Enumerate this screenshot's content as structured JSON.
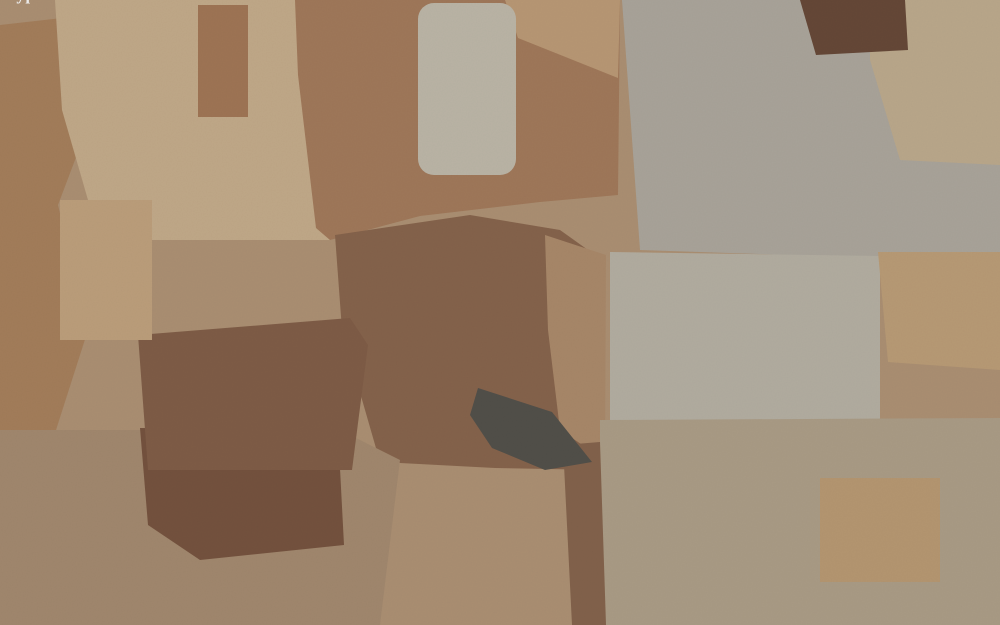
{
  "watermarks": {
    "top_left": {
      "text": "BuySell Cyprus",
      "x": 108,
      "y": 106,
      "angle": -45,
      "size": 27
    },
    "bottom_right": {
      "text": "BuySell Cyprus",
      "x": 887,
      "y": 523,
      "angle": -46,
      "size": 28
    }
  },
  "overlay": {
    "color": "#d61616",
    "stroke_width": 2.6,
    "parcels": [
      [
        [
          404,
          210
        ],
        [
          520,
          249
        ],
        [
          541,
          263
        ],
        [
          552,
          287
        ],
        [
          557,
          322
        ],
        [
          561,
          362
        ],
        [
          564,
          402
        ],
        [
          567,
          440
        ],
        [
          571,
          461
        ],
        [
          556,
          453
        ],
        [
          551,
          418
        ],
        [
          547,
          378
        ],
        [
          541,
          343
        ],
        [
          532,
          316
        ],
        [
          516,
          296
        ],
        [
          490,
          279
        ],
        [
          393,
          239
        ]
      ],
      [
        [
          466,
          213
        ],
        [
          531,
          241
        ],
        [
          578,
          263
        ],
        [
          603,
          278
        ],
        [
          604,
          332
        ],
        [
          600,
          392
        ],
        [
          597,
          442
        ],
        [
          595,
          467
        ],
        [
          577,
          473
        ],
        [
          556,
          463
        ],
        [
          534,
          446
        ],
        [
          515,
          427
        ],
        [
          503,
          407
        ],
        [
          497,
          388
        ],
        [
          491,
          358
        ],
        [
          485,
          330
        ],
        [
          477,
          308
        ],
        [
          469,
          286
        ],
        [
          463,
          254
        ]
      ]
    ]
  }
}
